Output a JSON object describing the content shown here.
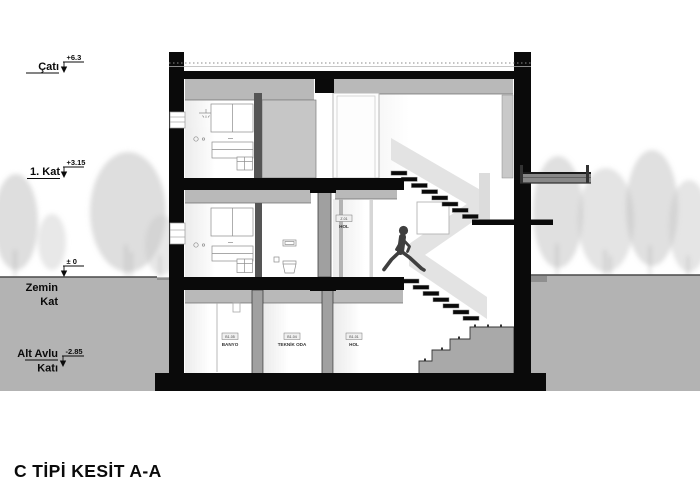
{
  "title": "C TİPİ KESİT A-A",
  "levels": [
    {
      "id": "roof",
      "label_line1": "Çatı",
      "label_line2": "",
      "elevation": "+6.3"
    },
    {
      "id": "first-floor",
      "label_line1": "1. Kat",
      "label_line2": "",
      "elevation": "+3.15"
    },
    {
      "id": "ground-floor",
      "label_line1": "Zemin",
      "label_line2": "Kat",
      "elevation": "± 0"
    },
    {
      "id": "basement",
      "label_line1": "Alt Avlu",
      "label_line2": "Katı",
      "elevation": "-2.85"
    }
  ],
  "rooms": [
    {
      "code": "Z.01",
      "name": "HOL"
    },
    {
      "code": "B1.05",
      "name": "BANYO"
    },
    {
      "code": "B1.04",
      "name": "TEKNİK ODA"
    },
    {
      "code": "B1.01",
      "name": "HOL"
    }
  ],
  "colors": {
    "ink": "#0a0a0a",
    "wall_poche": "#a0a0a0",
    "ceiling_band": "#b9b9b9",
    "ground": "#b3b3b3",
    "stair_ribbon": "#e3e3e3",
    "concrete_steps": "#a9a9a9",
    "figure": "#3f3f3f",
    "tree": "#c2c2c2"
  }
}
